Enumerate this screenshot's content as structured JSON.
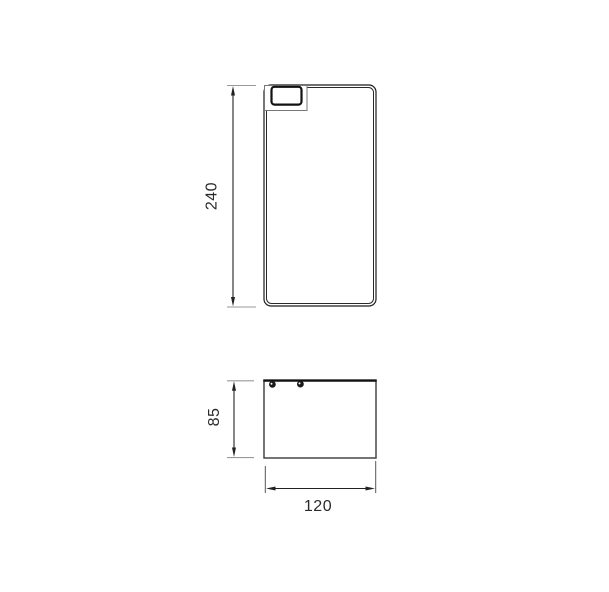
{
  "drawing": {
    "dimensions": {
      "front_height": "240",
      "base_height": "85",
      "base_width": "120"
    },
    "colors": {
      "background": "#ffffff",
      "outline": "#1c1c1c",
      "detail_outline": "#777777",
      "extension_line": "#9a9a9a",
      "dimension_line": "#222222",
      "dimension_text": "#2a2a2a"
    },
    "features": {
      "screw_dots": 2,
      "views": 2
    }
  }
}
